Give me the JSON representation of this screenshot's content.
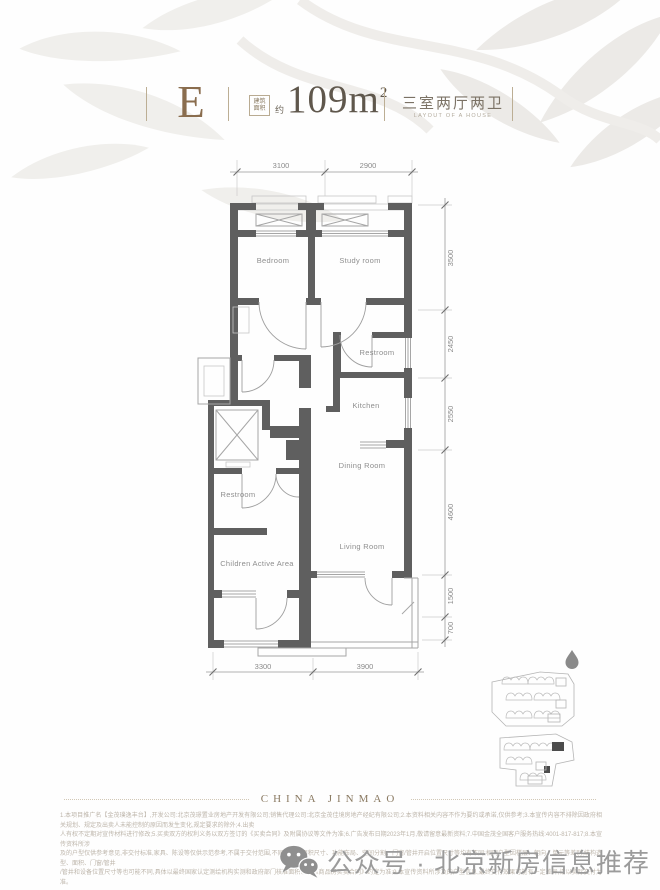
{
  "header": {
    "unit_letter": "E",
    "area_box_line1": "建筑",
    "area_box_line2": "面积",
    "area_prefix": "约",
    "area_value": "109m",
    "area_superscript": "2",
    "layout_cn": "三室两厅两卫",
    "layout_en": "LAYOUT OF A HOUSE"
  },
  "floorplan": {
    "rooms": {
      "bedroom": "Bedroom",
      "study": "Study room",
      "restroom_upper": "Restroom",
      "kitchen": "Kitchen",
      "dining": "Dining Room",
      "living": "Living Room",
      "restroom_lower": "Restroom",
      "children": "Children Active Area"
    },
    "dims": {
      "top": [
        "3100",
        "2900"
      ],
      "right": [
        "3500",
        "2450",
        "2550",
        "4600",
        "1500",
        "700"
      ],
      "bottom": [
        "3300",
        "3900"
      ]
    }
  },
  "icons": {
    "north_marker": "droplet-north-marker",
    "wechat": "wechat-logo"
  },
  "footer": {
    "brand": "CHINA JINMAO",
    "disclaimer": [
      "1.本项目推广名【金茂璞逸丰台】,开发公司:北京茂璟置业房地产开发有限公司;销售代理公司:北京金茂佳境房地产经纪有限公司;2.本资料相关内容不作为要约或承诺,仅供参考;3.本宣传内容不排除因政府相关规划、规定及出卖人未能控制的原因而发生变化,规定要求的除外;4.出卖",
      "人有权不定期对宣传材料进行修改;5.买卖双方的权利义务以双方签订的《买卖合同》及附属协议等文件为准;6.广告发布日期2023年1月,敬请留意最新资料;7.中国金茂全国客户服务热线:4001-817-817;8.本宣传资料所涉",
      "及的户型仅供参考意见,非交付标准,家具、陈设等仅供示范参考,不属于交付范围,不同户型的面积尺寸、功能布局、空间分割、门窗/管井开启位置尺寸等均有不同;相同户型因楼层、朝向、单元等差别,结构造型、面积、门窗/管井",
      "/管井和设备位置尺寸等也可能不同,具体以最终国家认定测绘机构实测和政府部门核准面积以及《商品房买卖合同》约定为准;9.本宣传资料所涉及的户型信息,最终交付效果可能有一定差异,请以实际交付为准。"
    ],
    "watermark_text": "公众号 · 北京新房信息推荐"
  },
  "colors": {
    "wall": "#5f5f5f",
    "accent_brown": "#8a6d4e",
    "area_text": "#5f574c",
    "dim_text": "#8a8a8a",
    "brand_gold": "#8a7a62",
    "watermark_gray": "#9b9b9b"
  }
}
